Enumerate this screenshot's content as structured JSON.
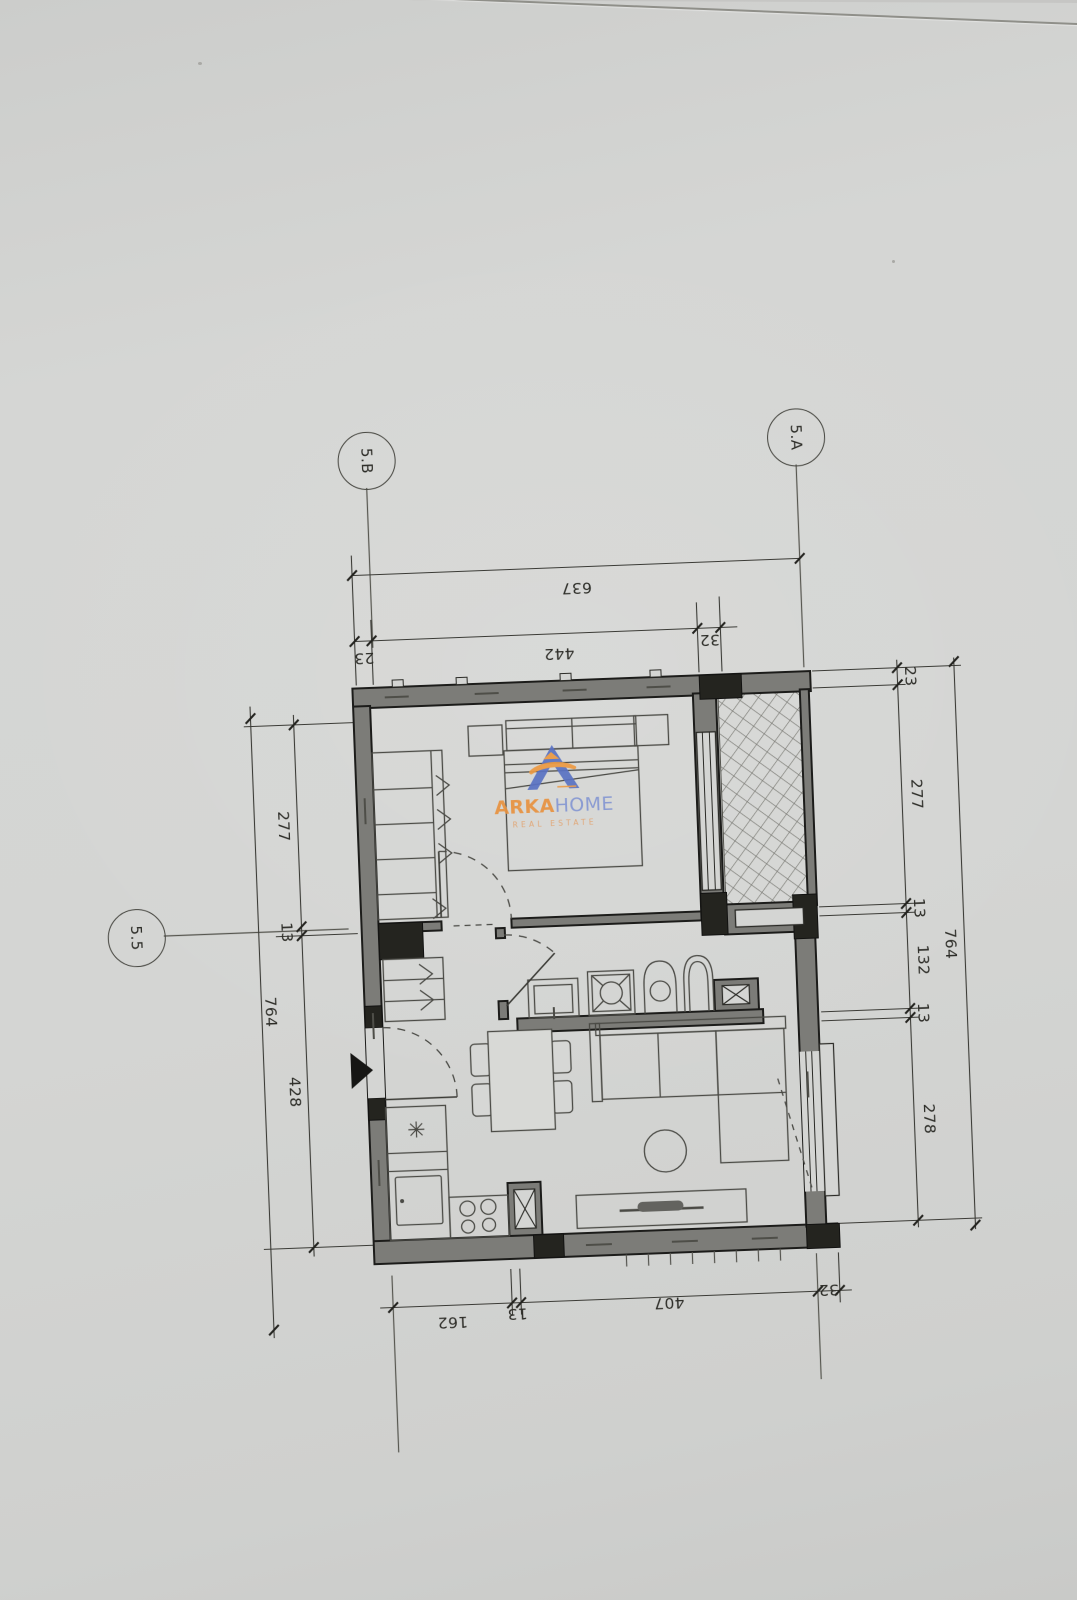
{
  "axes": {
    "top_left": "5.B",
    "top_right": "5.A",
    "left": "5.5"
  },
  "dimensions": {
    "top_total": "637",
    "top_chain": [
      "23",
      "442",
      "32"
    ],
    "right_chain": [
      "23",
      "277",
      "13",
      "132",
      "13",
      "278"
    ],
    "right_total": "764",
    "left_chain": [
      "277",
      "13",
      "428"
    ],
    "left_total": "764",
    "bottom_chain": [
      "162",
      "13",
      "407",
      "32"
    ]
  },
  "watermark": {
    "brand_primary": "ARKA",
    "brand_secondary": "HOME",
    "tagline": "REAL ESTATE"
  },
  "colors": {
    "paper": "#d4d5d3",
    "wall_fill": "#7c7c78",
    "wall_dark": "#24241f",
    "line": "#3b3b36",
    "accent_orange": "#e8923f",
    "accent_blue": "#8496d2"
  }
}
